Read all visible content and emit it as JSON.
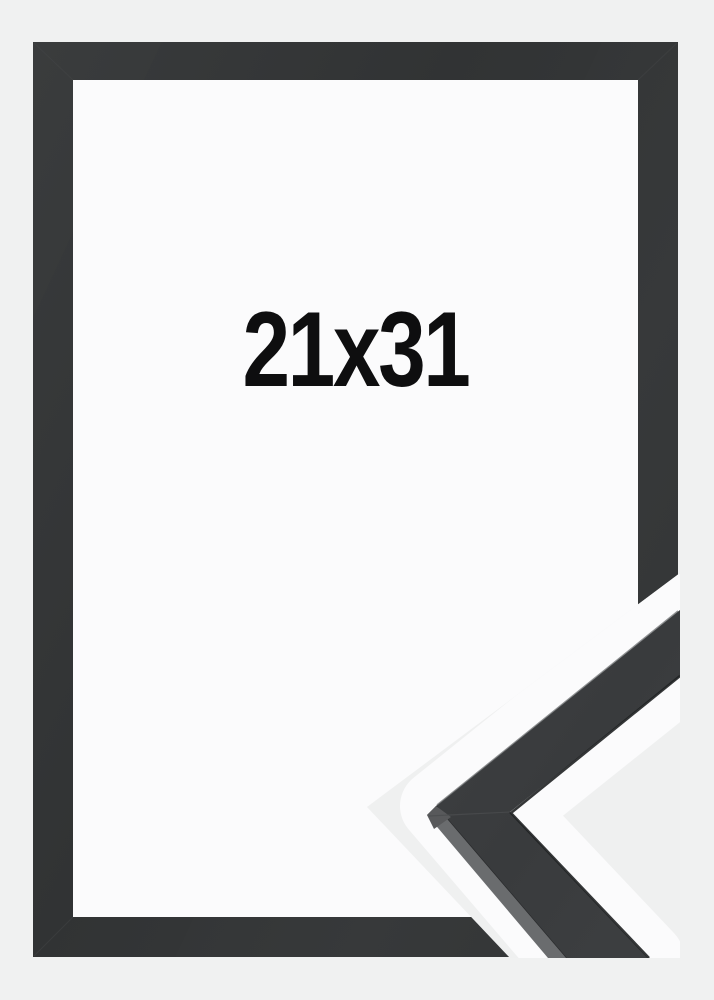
{
  "product_image": {
    "size_label": "21x31",
    "description_front": "black picture frame front view with empty white opening",
    "description_detail": "close-up of frame corner moulding profile, composited diagonally at bottom right",
    "colors": {
      "background": "#f0f1f1",
      "frame_border": "#343637",
      "frame_opening": "#fbfbfc",
      "label_text": "#0e0e0f",
      "separator_stripe": "#fbfbfc",
      "moulding_top_face": "#3a3c3e",
      "moulding_side_face": "#6a6c6e",
      "detail_background": "#eff0f0"
    }
  }
}
